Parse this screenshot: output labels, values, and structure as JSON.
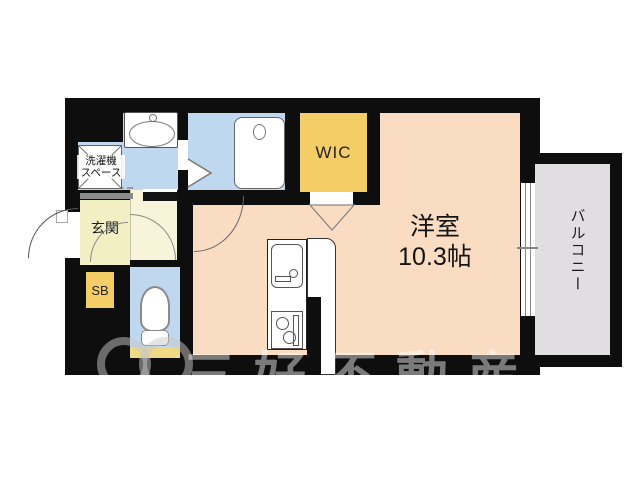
{
  "floorplan": {
    "rooms": {
      "main_room": {
        "name": "洋室",
        "size": "10.3帖"
      },
      "wic": {
        "label": "WIC"
      },
      "balcony": {
        "label": "バルコニー"
      },
      "entrance": {
        "label": "玄関"
      },
      "shoe_box": {
        "label": "SB"
      },
      "washer_space": {
        "label_line1": "洗濯機",
        "label_line2": "スペース"
      }
    },
    "colors": {
      "wall": "#0E0E0E",
      "main_room_floor": "#FADCC3",
      "wet_area_floor": "#BFD8F0",
      "wic_floor": "#F5CD67",
      "entrance_floor": "#F3EFC5",
      "hallway_floor": "#F7F4D9",
      "balcony_floor": "#E0DEE1",
      "toilet_mat": "#F0D985"
    },
    "watermark": {
      "company_text": "三好不動産"
    }
  }
}
